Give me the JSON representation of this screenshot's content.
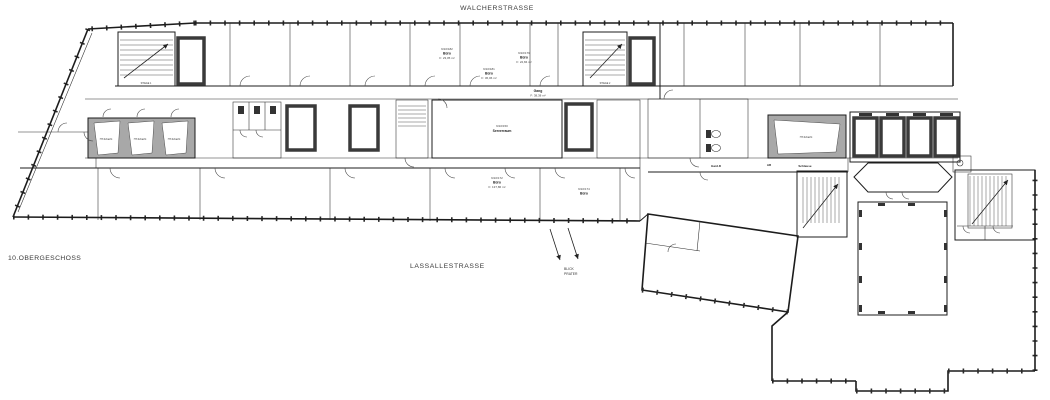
{
  "labels": {
    "street_top": "WALCHERSTRASSE",
    "street_bottom": "LASSALLESTRASSE",
    "floor": "10.OBERGESCHOSS",
    "view_line1": "BLICK",
    "view_line2": "PRATER",
    "rooms": [
      {
        "number": "9/10/182",
        "name": "Büro",
        "area": "F: 23,05 m²"
      },
      {
        "number": "9/10/181",
        "name": "Büro",
        "area": "F: 36,06 m²"
      },
      {
        "number": "9/10/179",
        "name": "Büro",
        "area": "F: 22,84 m²"
      },
      {
        "name": "Gang",
        "area": "F: 38,38 m²"
      },
      {
        "number": "9/10/150",
        "name": "Serverraum"
      },
      {
        "number": "9/10/172",
        "name": "Büro",
        "area": "F: 137,86 m²"
      },
      {
        "number": "9/10/174",
        "name": "Büro"
      },
      {
        "name": "STIEGE 1"
      },
      {
        "name": "STIEGE 2"
      },
      {
        "name": "HT-Schacht"
      },
      {
        "name": "HT-Schacht"
      },
      {
        "name": "HT-Schacht"
      },
      {
        "name": "HT-Schacht"
      },
      {
        "name": "Gard.D"
      },
      {
        "name": "AR"
      },
      {
        "name": "Schleuse"
      }
    ]
  },
  "colors": {
    "background": "#ffffff",
    "wall": "#1c1c1c",
    "facade": "#2b2b2b",
    "shaft_shading": "#a8a8a8",
    "elevator_wall": "#3a3a3a"
  }
}
